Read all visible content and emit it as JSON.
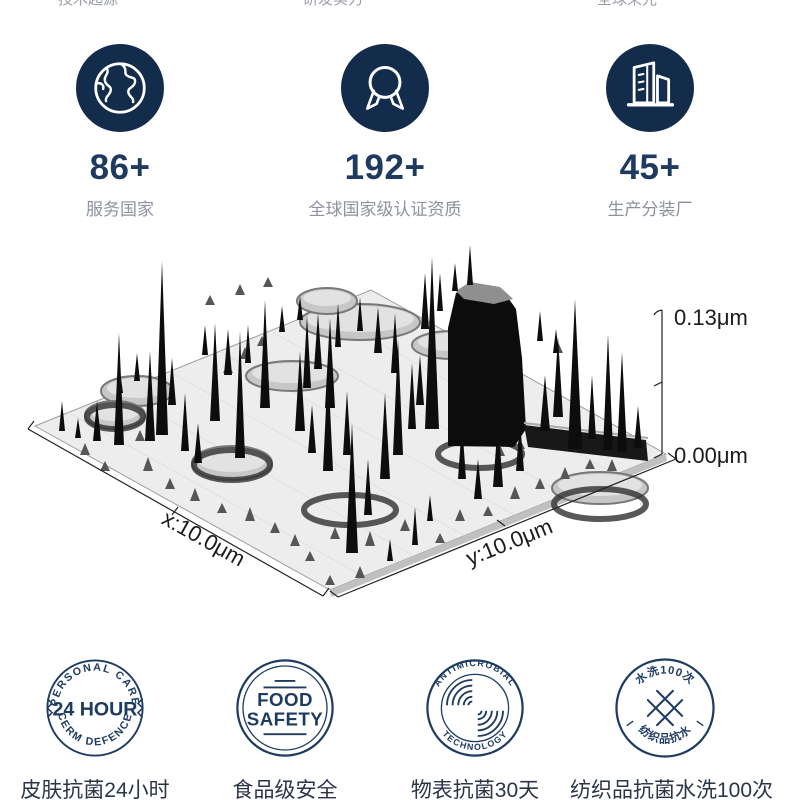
{
  "top_clipped_row": {
    "left": "技术起源",
    "middle": "研发实力",
    "right": "全球荣光"
  },
  "stats": {
    "items": [
      {
        "icon": "globe-icon",
        "value": "86+",
        "label": "服务国家"
      },
      {
        "icon": "medal-icon",
        "value": "192+",
        "label": "全球国家级认证资质"
      },
      {
        "icon": "building-icon",
        "value": "45+",
        "label": "生产分装厂"
      }
    ]
  },
  "afm_plot": {
    "type": "3d-surface",
    "z_max_label": "0.13μm",
    "z_min_label": "0.00μm",
    "x_axis_label": "x:10.0μm",
    "y_axis_label": "y:10.0μm",
    "plate": {
      "corners": [
        [
          35,
          193
        ],
        [
          371,
          57
        ],
        [
          666,
          221
        ],
        [
          330,
          357
        ]
      ]
    },
    "spikes": [
      [
        162,
        202,
        174,
        6
      ],
      [
        119,
        212,
        112,
        5
      ],
      [
        150,
        208,
        90,
        5
      ],
      [
        172,
        172,
        47,
        4
      ],
      [
        215,
        188,
        98,
        5
      ],
      [
        240,
        225,
        127,
        5
      ],
      [
        265,
        175,
        108,
        5
      ],
      [
        307,
        155,
        73,
        4
      ],
      [
        330,
        175,
        90,
        5
      ],
      [
        347,
        222,
        64,
        4
      ],
      [
        97,
        208,
        40,
        4
      ],
      [
        78,
        205,
        20,
        3
      ],
      [
        62,
        198,
        30,
        3
      ],
      [
        137,
        148,
        28,
        3
      ],
      [
        120,
        160,
        22,
        3
      ],
      [
        185,
        218,
        58,
        4
      ],
      [
        198,
        230,
        40,
        4
      ],
      [
        228,
        142,
        46,
        4
      ],
      [
        248,
        130,
        38,
        3
      ],
      [
        205,
        122,
        30,
        3
      ],
      [
        352,
        320,
        130,
        6
      ],
      [
        368,
        282,
        56,
        4
      ],
      [
        385,
        246,
        86,
        5
      ],
      [
        398,
        222,
        116,
        5
      ],
      [
        412,
        196,
        66,
        4
      ],
      [
        420,
        172,
        50,
        4
      ],
      [
        432,
        196,
        172,
        7
      ],
      [
        425,
        96,
        56,
        4
      ],
      [
        440,
        78,
        38,
        3
      ],
      [
        455,
        58,
        28,
        3
      ],
      [
        470,
        52,
        40,
        3
      ],
      [
        318,
        136,
        56,
        4
      ],
      [
        338,
        114,
        44,
        3
      ],
      [
        360,
        98,
        34,
        3
      ],
      [
        378,
        120,
        46,
        4
      ],
      [
        395,
        140,
        60,
        4
      ],
      [
        300,
        198,
        80,
        5
      ],
      [
        312,
        220,
        48,
        4
      ],
      [
        328,
        238,
        106,
        5
      ],
      [
        545,
        198,
        56,
        5
      ],
      [
        558,
        184,
        80,
        5
      ],
      [
        575,
        216,
        150,
        7
      ],
      [
        592,
        206,
        64,
        4
      ],
      [
        608,
        217,
        116,
        5
      ],
      [
        622,
        219,
        100,
        5
      ],
      [
        638,
        215,
        42,
        4
      ],
      [
        462,
        246,
        56,
        4
      ],
      [
        478,
        266,
        40,
        4
      ],
      [
        498,
        254,
        66,
        5
      ],
      [
        520,
        238,
        50,
        4
      ],
      [
        415,
        312,
        38,
        3
      ],
      [
        430,
        288,
        26,
        3
      ],
      [
        390,
        328,
        22,
        3
      ],
      [
        540,
        108,
        30,
        3
      ],
      [
        556,
        120,
        24,
        3
      ],
      [
        300,
        87,
        24,
        3
      ],
      [
        282,
        99,
        26,
        3
      ]
    ],
    "bumps": [
      [
        85,
        222,
        12
      ],
      [
        105,
        238,
        10
      ],
      [
        148,
        238,
        14
      ],
      [
        170,
        256,
        11
      ],
      [
        195,
        268,
        13
      ],
      [
        222,
        280,
        10
      ],
      [
        250,
        288,
        14
      ],
      [
        275,
        300,
        11
      ],
      [
        295,
        313,
        12
      ],
      [
        310,
        328,
        10
      ],
      [
        140,
        208,
        11
      ],
      [
        335,
        306,
        12
      ],
      [
        370,
        313,
        15
      ],
      [
        405,
        298,
        12
      ],
      [
        440,
        310,
        10
      ],
      [
        460,
        288,
        12
      ],
      [
        488,
        283,
        10
      ],
      [
        515,
        266,
        13
      ],
      [
        540,
        256,
        11
      ],
      [
        565,
        246,
        12
      ],
      [
        590,
        236,
        10
      ],
      [
        612,
        238,
        12
      ],
      [
        520,
        216,
        10
      ],
      [
        500,
        223,
        11
      ],
      [
        558,
        120,
        11
      ],
      [
        262,
        113,
        10
      ],
      [
        245,
        126,
        12
      ],
      [
        228,
        140,
        10
      ],
      [
        210,
        72,
        10
      ],
      [
        240,
        62,
        11
      ],
      [
        268,
        54,
        10
      ],
      [
        360,
        345,
        12
      ],
      [
        330,
        352,
        10
      ]
    ],
    "plateaus": [
      [
        137,
        158,
        36,
        15
      ],
      [
        115,
        182,
        30,
        14
      ],
      [
        292,
        143,
        46,
        15
      ],
      [
        232,
        230,
        40,
        17
      ],
      [
        360,
        89,
        60,
        18
      ],
      [
        452,
        112,
        40,
        14
      ],
      [
        327,
        68,
        30,
        13
      ],
      [
        600,
        255,
        48,
        16
      ]
    ],
    "rings": [
      [
        232,
        232,
        38,
        15
      ],
      [
        350,
        277,
        46,
        15
      ],
      [
        480,
        221,
        42,
        14
      ],
      [
        600,
        271,
        46,
        15
      ],
      [
        115,
        184,
        28,
        12
      ]
    ]
  },
  "badges": {
    "items": [
      {
        "arc_top": "PERSONAL CARE",
        "center": "24 HOUR",
        "arc_bottom": "CERM DEFENCE",
        "caption": "皮肤抗菌24小时"
      },
      {
        "line1": "FOOD",
        "line2": "SAFETY",
        "caption": "食品级安全"
      },
      {
        "arc_top": "ANTIMICROBIAL",
        "arc_bottom": "TECHNOLOGY",
        "caption": "物表抗菌30天"
      },
      {
        "arc_top": "水洗100次",
        "arc_bottom": "纺织品抗水",
        "caption": "纺织品抗菌水洗100次"
      }
    ]
  },
  "colors": {
    "circle_navy": "#142c4c",
    "stat_value_navy": "#1e3a5f",
    "caption_gray": "#8d929c",
    "badge_navy": "#1e3c62",
    "bottom_label": "#2b3547"
  }
}
